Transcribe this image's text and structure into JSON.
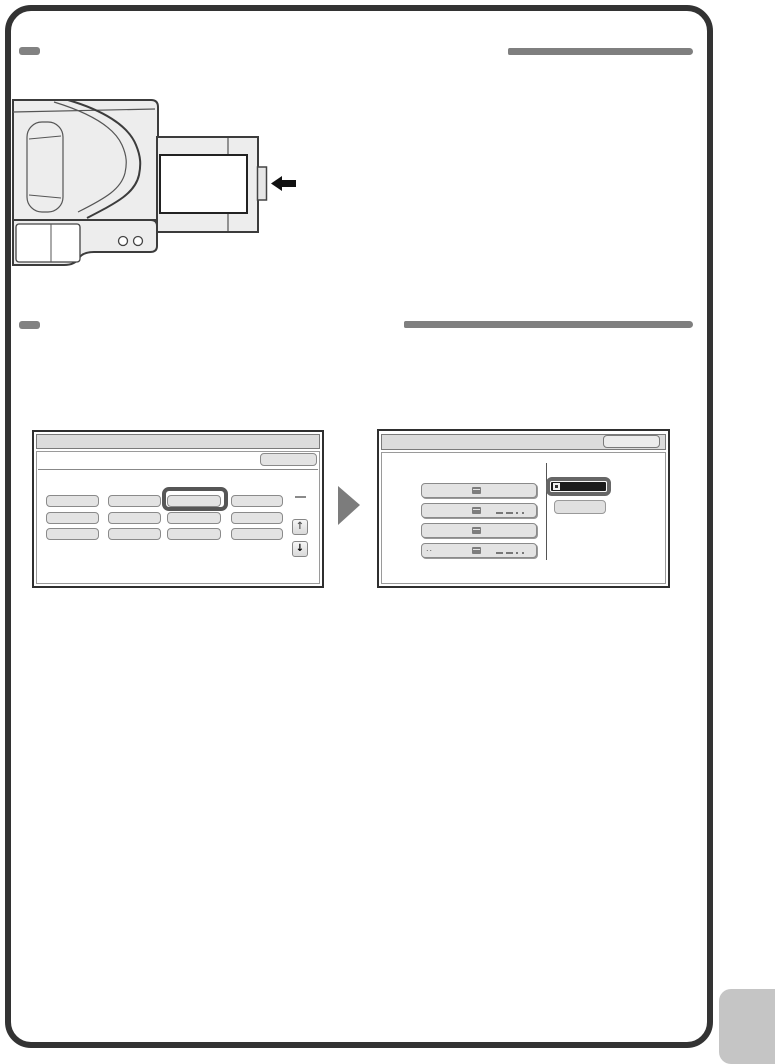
{
  "page": {
    "background": "#ffffff",
    "border_color": "#333333",
    "section_marker_color": "#828282",
    "heading_bar_color": "#7f7f7f",
    "corner_tab_color": "#c5c5c5"
  },
  "sections": [
    {
      "id": 1,
      "heading_text": ""
    },
    {
      "id": 2,
      "heading_text": ""
    }
  ],
  "illustration": {
    "name": "machine-with-usb-device-insertion",
    "body_fill": "#ededed",
    "outline_color": "#3c3c3c",
    "display_fill": "#ffffff",
    "insert_arrow_color": "#111111",
    "icons": [
      "usb-device",
      "insert-arrow-icon",
      "indicator-light"
    ]
  },
  "flow_arrow_color": "#7c7c7c",
  "screens": {
    "home": {
      "title_text": "",
      "top_button_label": "",
      "grid": {
        "rows": 3,
        "cols": 4,
        "highlighted": {
          "row": 0,
          "col": 2
        }
      },
      "button_fill": "#e3e3e3",
      "highlight_border": "#565656",
      "scroll_up_glyph": "↑",
      "scroll_down_glyph": "↓"
    },
    "file_select": {
      "title_text": "",
      "title_button_label": "",
      "items": [
        {
          "prefix": "",
          "redacted_text": false
        },
        {
          "prefix": "",
          "redacted_text": true
        },
        {
          "prefix": "",
          "redacted_text": false
        },
        {
          "prefix": "..",
          "redacted_text": true
        }
      ],
      "selected_item_fill": "#1b1b1b",
      "sub_button_label": ""
    }
  }
}
